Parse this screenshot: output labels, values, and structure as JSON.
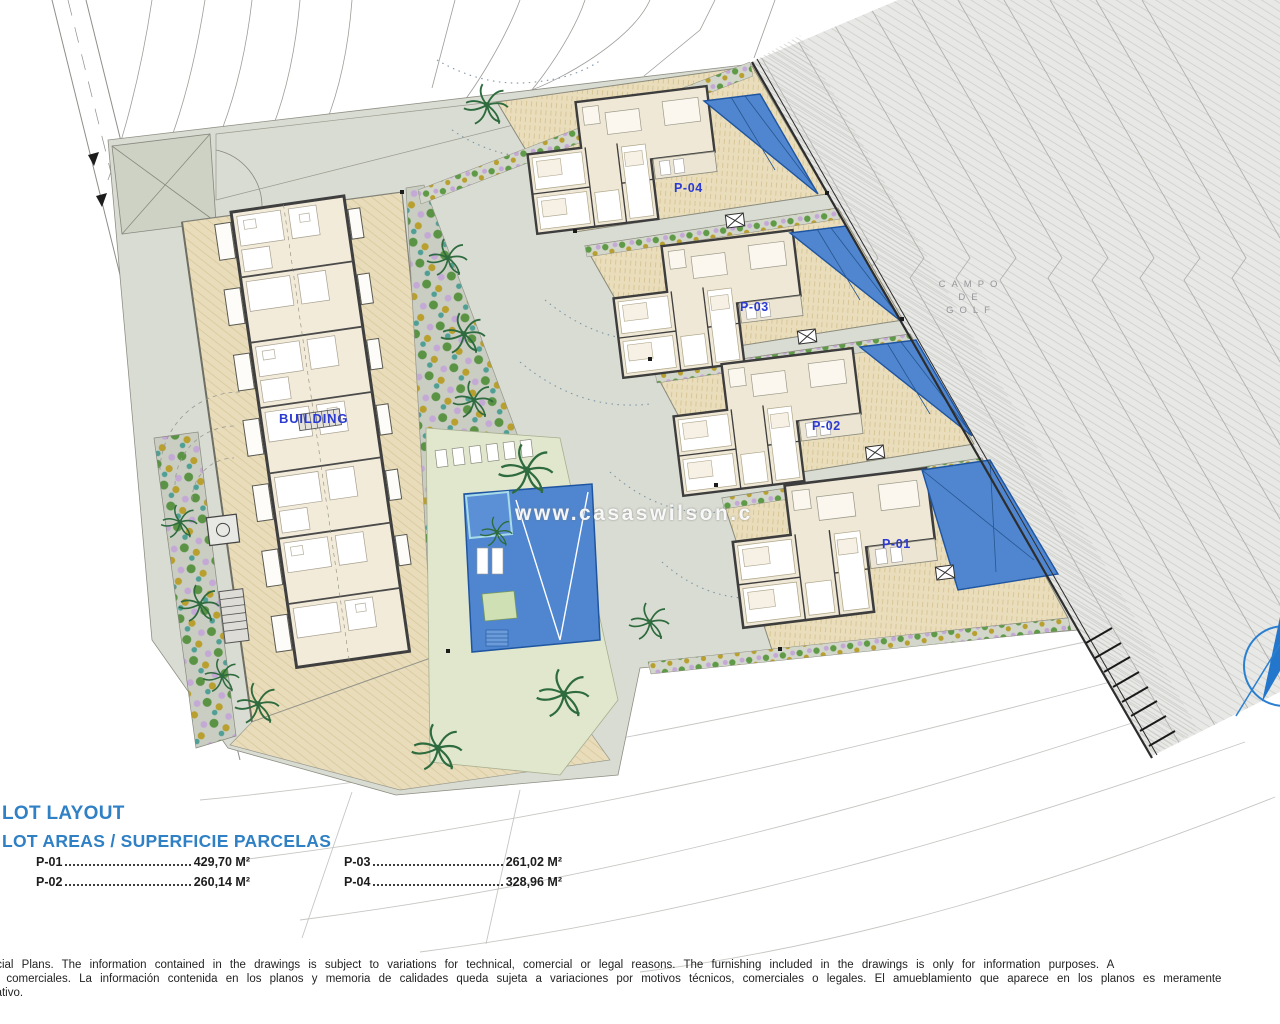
{
  "plan": {
    "watermark": "www.casaswilson.c",
    "building_label": "BUILDING",
    "plot_labels": [
      "P-04",
      "P-03",
      "P-02",
      "P-01"
    ],
    "golf_course_label": [
      "CAMPO",
      "DE",
      "GOLF"
    ],
    "label_color": "#2b3bd2",
    "pool_color": "#4f86cf"
  },
  "legend": {
    "title": "LOT LAYOUT",
    "subtitle": "LOT AREAS / SUPERFICIE PARCELAS",
    "title_color": "#2f80c4",
    "columns": [
      [
        {
          "label": "P-01",
          "value": "429,70 M²"
        },
        {
          "label": "P-02",
          "value": "260,14 M²"
        }
      ],
      [
        {
          "label": "P-03",
          "value": "261,02 M²"
        },
        {
          "label": "P-04",
          "value": "328,96 M²"
        }
      ]
    ]
  },
  "disclaimer": {
    "lines": [
      "ercial Plans. The information contained in the drawings is subject to variations for technical, comercial or legal reasons. The furnishing included in the drawings is only for information purposes. A",
      "os comerciales. La información contenida en los planos y memoria de calidades queda sujeta a variaciones por motivos técnicos, comerciales o legales. El amueblamiento que aparece en los planos es meramente",
      "mativo."
    ]
  }
}
